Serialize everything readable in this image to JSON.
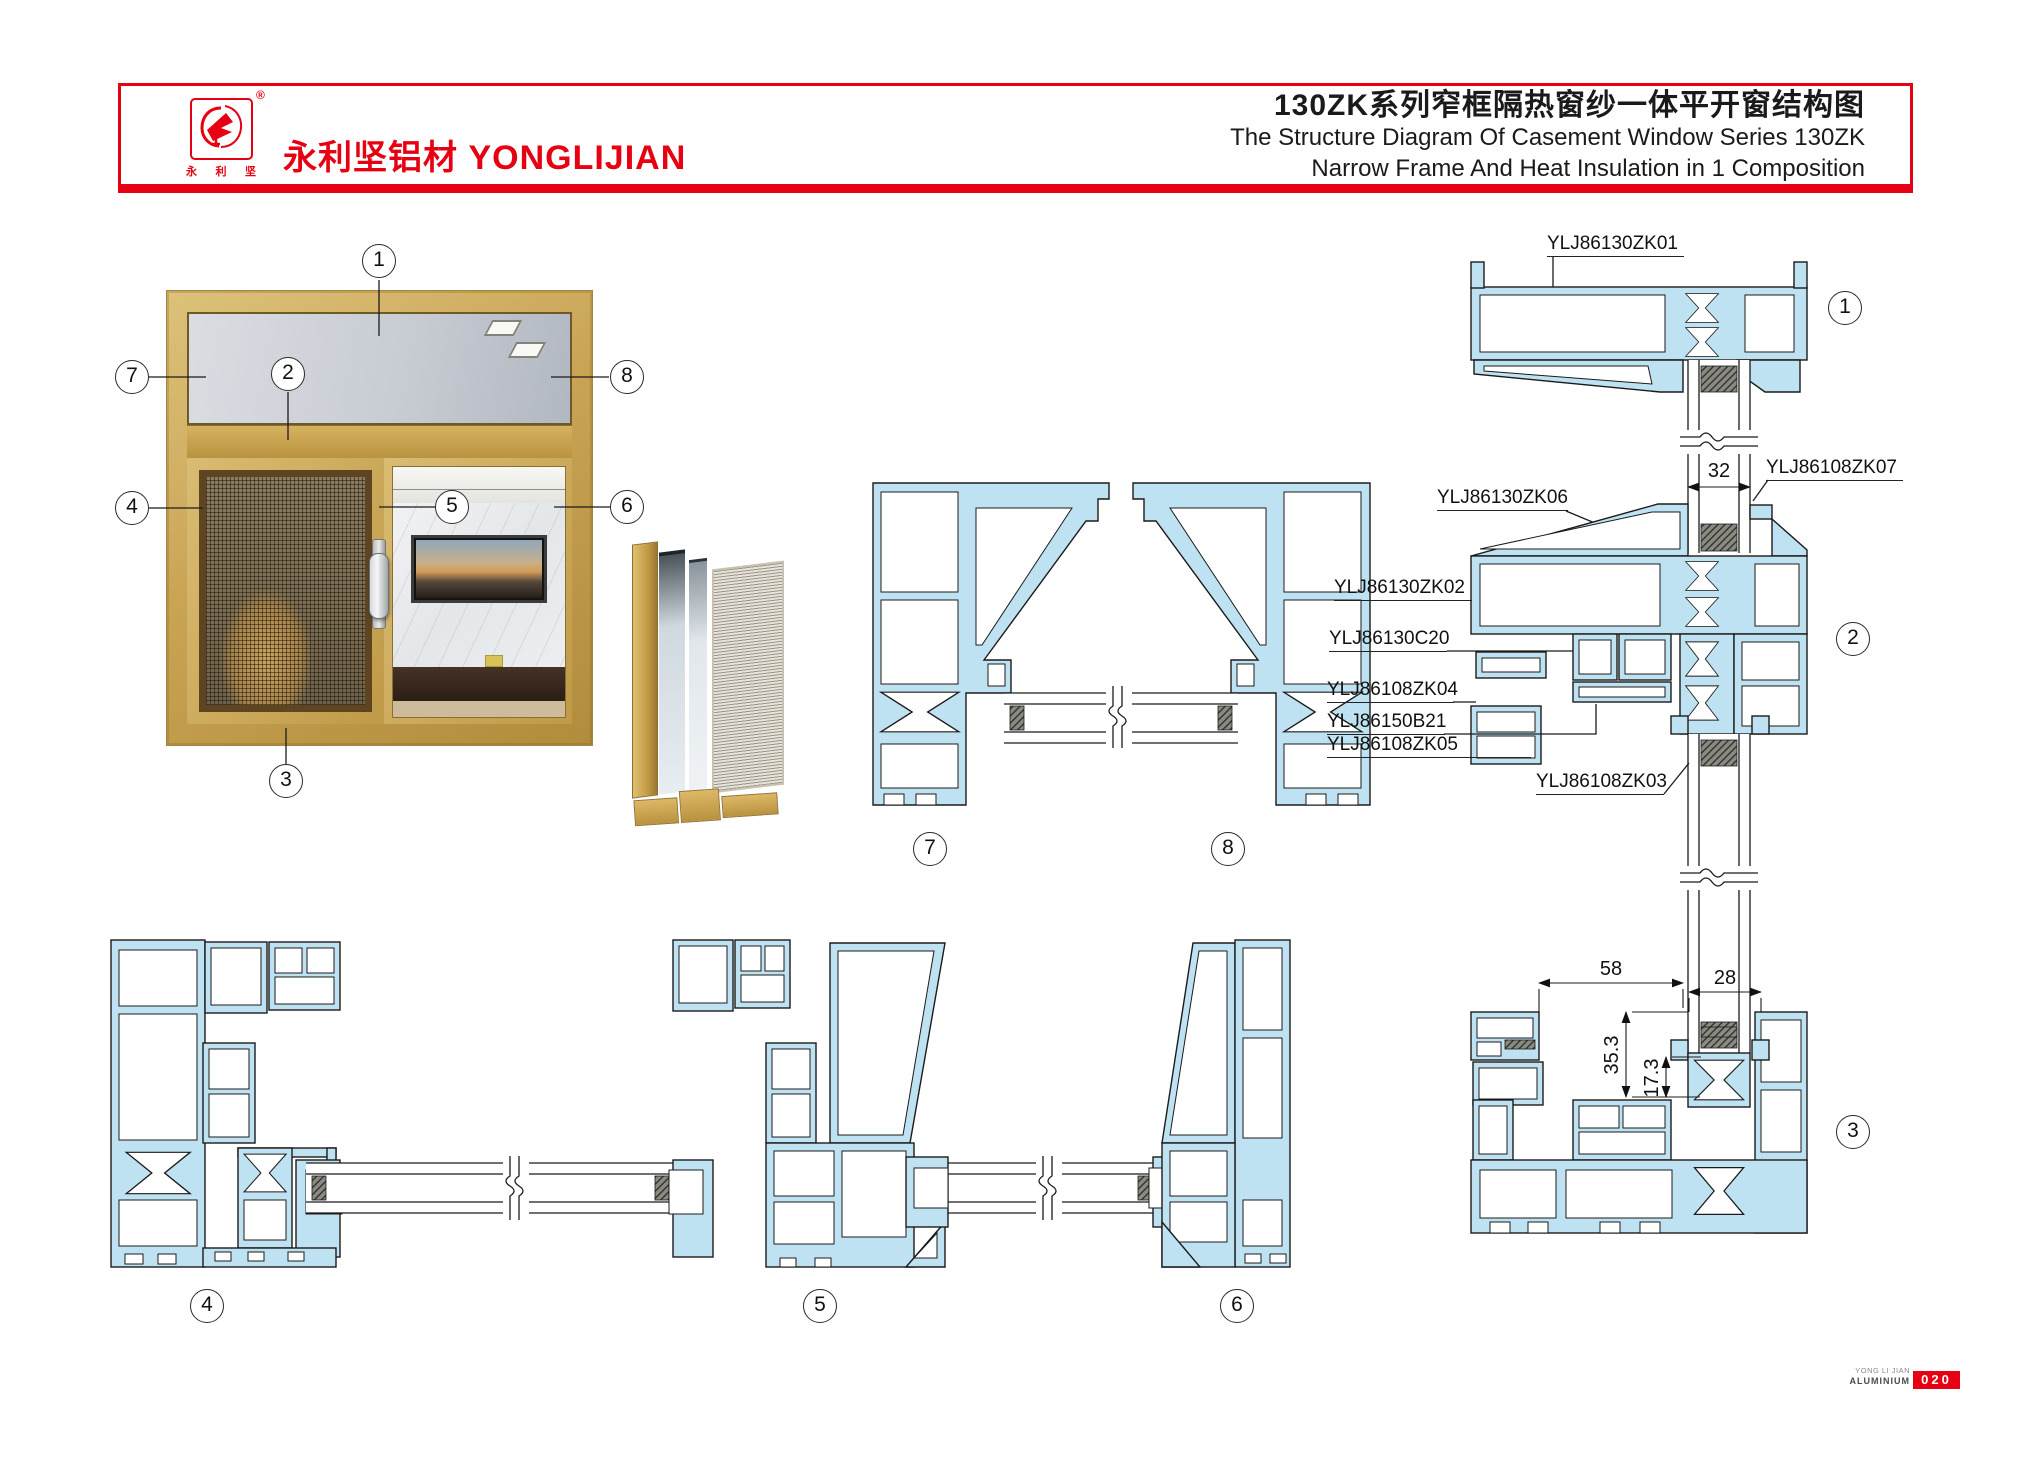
{
  "header": {
    "logo_reg": "®",
    "logo_chars": [
      "永",
      "利",
      "坚"
    ],
    "brand": "永利坚铝材 YONGLIJIAN",
    "title_cn": "130ZK系列窄框隔热窗纱一体平开窗结构图",
    "title_en1": "The Structure Diagram Of Casement Window Series 130ZK",
    "title_en2": "Narrow Frame And Heat Insulation in 1 Composition"
  },
  "callouts": {
    "1": "1",
    "2": "2",
    "3": "3",
    "4": "4",
    "5": "5",
    "6": "6",
    "7": "7",
    "8": "8"
  },
  "part_labels": {
    "zk01": "YLJ86130ZK01",
    "zk07": "YLJ86108ZK07",
    "zk06": "YLJ86130ZK06",
    "zk02": "YLJ86130ZK02",
    "c20": "YLJ86130C20",
    "zk04": "YLJ86108ZK04",
    "b21": "YLJ86150B21",
    "zk05": "YLJ86108ZK05",
    "zk03": "YLJ86108ZK03"
  },
  "dimensions": {
    "d32": "32",
    "d58": "58",
    "d28": "28",
    "d353": "35.3",
    "d173": "17.3"
  },
  "footer": {
    "brand_line1": "YONG LI JIAN",
    "brand_line2": "ALUMINIUM",
    "page": "020"
  },
  "colors": {
    "accent_red": "#e60012",
    "profile_blue": "#bfe2f2",
    "gold": "#c9a455"
  }
}
